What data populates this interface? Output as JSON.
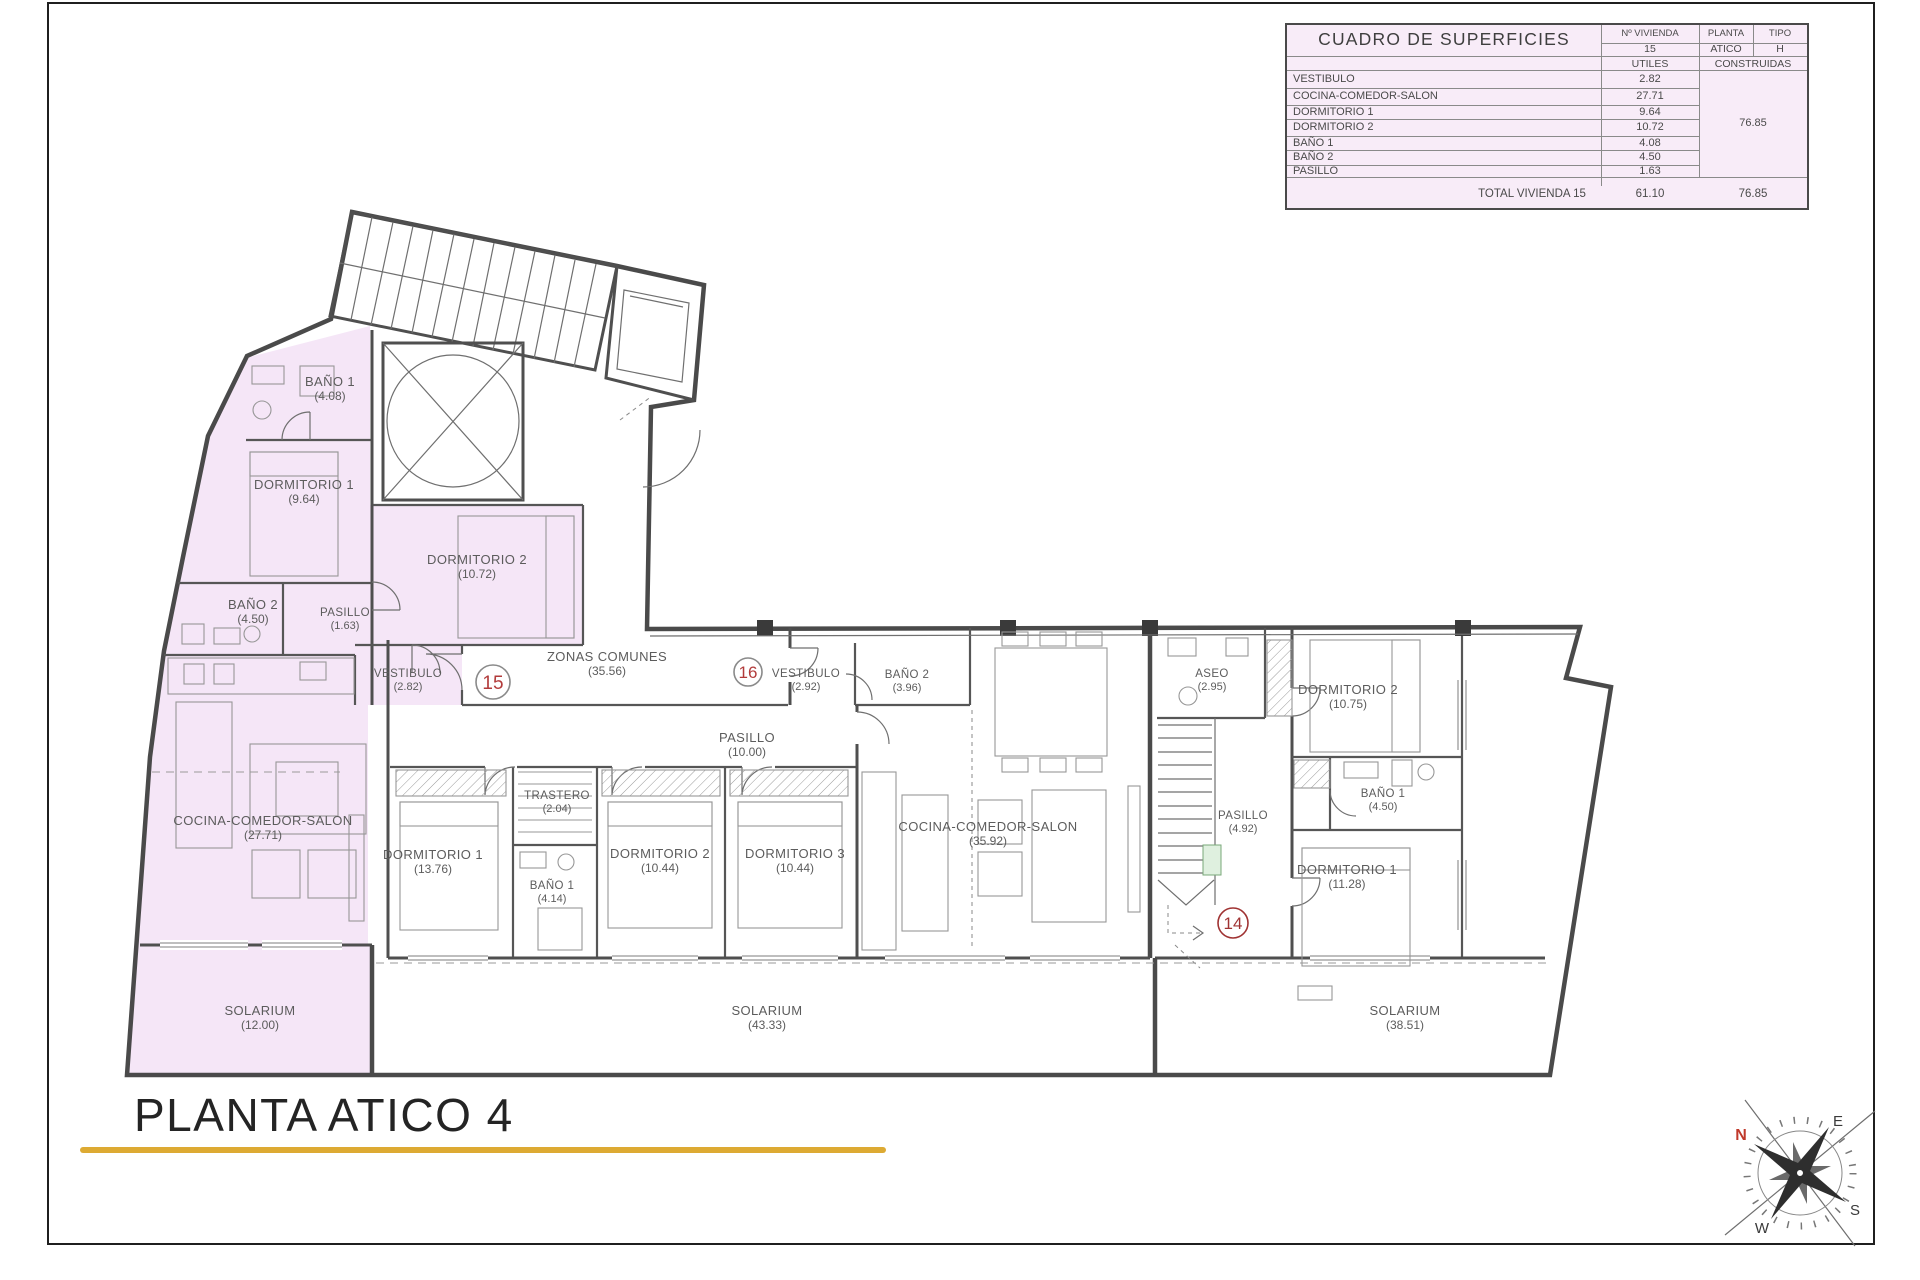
{
  "table": {
    "title": "CUADRO DE SUPERFICIES",
    "cols": {
      "vivienda": "Nº VIVIENDA",
      "planta": "PLANTA",
      "tipo": "TIPO"
    },
    "unit": {
      "vivienda": "15",
      "planta": "ATICO",
      "tipo": "H"
    },
    "area_cols": {
      "utiles": "UTILES",
      "construidas": "CONSTRUIDAS"
    },
    "rows": [
      {
        "name": "VESTIBULO",
        "utiles": "2.82"
      },
      {
        "name": "COCINA-COMEDOR-SALON",
        "utiles": "27.71"
      },
      {
        "name": "DORMITORIO 1",
        "utiles": "9.64"
      },
      {
        "name": "DORMITORIO 2",
        "utiles": "10.72"
      },
      {
        "name": "BAÑO 1",
        "utiles": "4.08"
      },
      {
        "name": "BAÑO 2",
        "utiles": "4.50"
      },
      {
        "name": "PASILLO",
        "utiles": "1.63"
      }
    ],
    "construidas_total": "76.85",
    "total": {
      "label": "TOTAL VIVIENDA 15",
      "utiles": "61.10",
      "construidas": "76.85"
    }
  },
  "plan": {
    "zonas": {
      "name": "ZONAS COMUNES",
      "area": "(35.56)"
    },
    "unit15": {
      "badge": "15",
      "rooms": [
        {
          "name": "BAÑO 1",
          "area": "(4.08)"
        },
        {
          "name": "DORMITORIO 1",
          "area": "(9.64)"
        },
        {
          "name": "DORMITORIO 2",
          "area": "(10.72)"
        },
        {
          "name": "BAÑO 2",
          "area": "(4.50)"
        },
        {
          "name": "PASILLO",
          "area": "(1.63)"
        },
        {
          "name": "VESTIBULO",
          "area": "(2.82)"
        },
        {
          "name": "COCINA-COMEDOR-SALON",
          "area": "(27.71)"
        },
        {
          "name": "SOLARIUM",
          "area": "(12.00)"
        }
      ]
    },
    "unit16": {
      "badge": "16",
      "rooms": [
        {
          "name": "VESTIBULO",
          "area": "(2.92)"
        },
        {
          "name": "BAÑO 2",
          "area": "(3.96)"
        },
        {
          "name": "PASILLO",
          "area": "(10.00)"
        },
        {
          "name": "TRASTERO",
          "area": "(2.04)"
        },
        {
          "name": "DORMITORIO 1",
          "area": "(13.76)"
        },
        {
          "name": "BAÑO 1",
          "area": "(4.14)"
        },
        {
          "name": "DORMITORIO 2",
          "area": "(10.44)"
        },
        {
          "name": "DORMITORIO 3",
          "area": "(10.44)"
        },
        {
          "name": "COCINA-COMEDOR-SALON",
          "area": "(35.92)"
        },
        {
          "name": "SOLARIUM",
          "area": "(43.33)"
        }
      ]
    },
    "unit14": {
      "badge": "14",
      "rooms": [
        {
          "name": "ASEO",
          "area": "(2.95)"
        },
        {
          "name": "DORMITORIO 2",
          "area": "(10.75)"
        },
        {
          "name": "BAÑO 1",
          "area": "(4.50)"
        },
        {
          "name": "PASILLO",
          "area": "(4.92)"
        },
        {
          "name": "DORMITORIO 1",
          "area": "(11.28)"
        },
        {
          "name": "SOLARIUM",
          "area": "(38.51)"
        }
      ]
    },
    "compass": {
      "n": "N",
      "e": "E",
      "s": "S",
      "w": "W"
    }
  },
  "footer": {
    "title": "PLANTA ATICO 4"
  },
  "colors": {
    "accent": "#ddaa33",
    "highlight": "#f5e6f7",
    "badge": "#b23b3b",
    "north": "#c0392b"
  }
}
